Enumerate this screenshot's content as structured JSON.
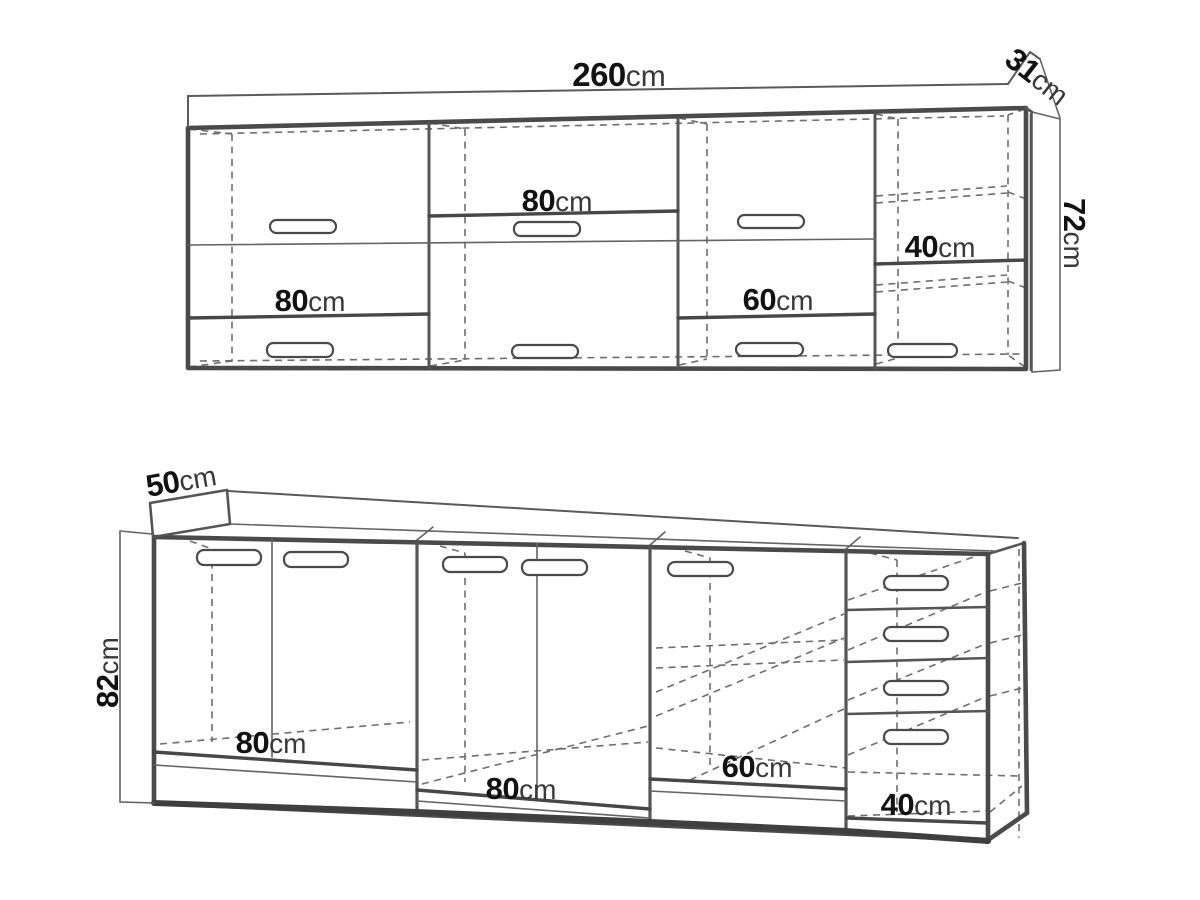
{
  "diagram": {
    "upper_cabinet": {
      "width": {
        "value": "260",
        "unit": "cm"
      },
      "depth": {
        "value": "31",
        "unit": "cm"
      },
      "height": {
        "value": "72",
        "unit": "cm"
      },
      "section_labels": [
        {
          "value": "80",
          "unit": "cm"
        },
        {
          "value": "80",
          "unit": "cm"
        },
        {
          "value": "60",
          "unit": "cm"
        },
        {
          "value": "40",
          "unit": "cm"
        }
      ]
    },
    "lower_cabinet": {
      "depth": {
        "value": "50",
        "unit": "cm"
      },
      "height": {
        "value": "82",
        "unit": "cm"
      },
      "section_labels": [
        {
          "value": "80",
          "unit": "cm"
        },
        {
          "value": "80",
          "unit": "cm"
        },
        {
          "value": "60",
          "unit": "cm"
        },
        {
          "value": "40",
          "unit": "cm"
        }
      ]
    }
  }
}
